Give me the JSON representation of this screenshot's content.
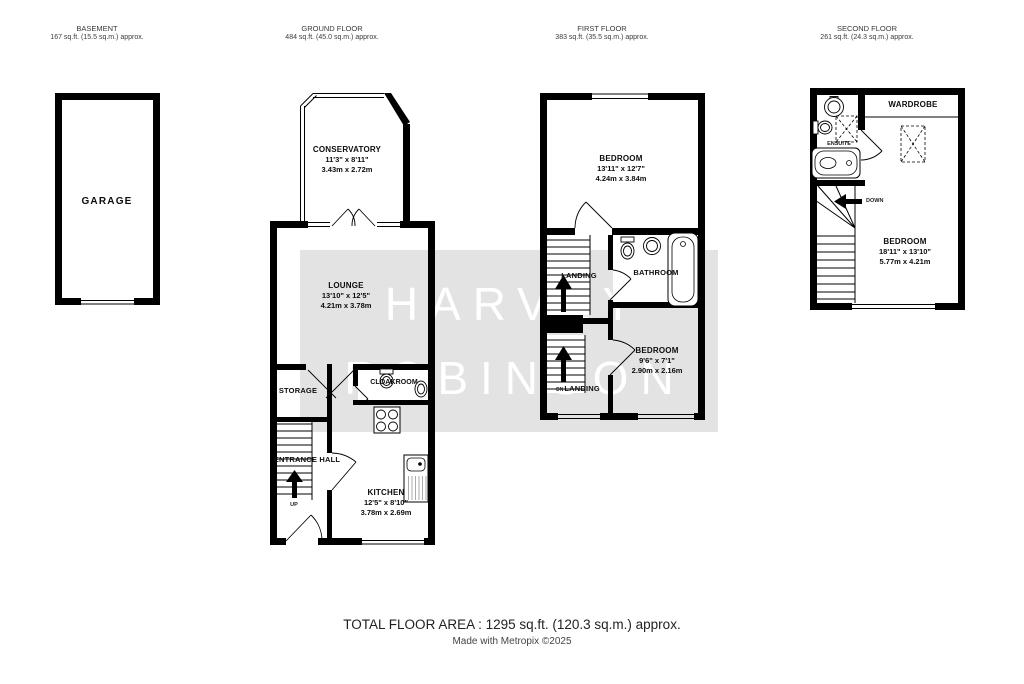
{
  "watermark": {
    "line1": "HARVEY",
    "line2": "ROBINSON"
  },
  "colors": {
    "wall": "#000000",
    "watermark_band": "#e3e3e3",
    "watermark_text": "#ffffff"
  },
  "floors": {
    "basement": {
      "title": "BASEMENT",
      "area": "167 sq.ft. (15.5 sq.m.) approx.",
      "rooms": {
        "garage": {
          "name": "GARAGE"
        }
      }
    },
    "ground": {
      "title": "GROUND FLOOR",
      "area": "484 sq.ft. (45.0 sq.m.) approx.",
      "rooms": {
        "conservatory": {
          "name": "CONSERVATORY",
          "imperial": "11'3\" x 8'11\"",
          "metric": "3.43m x 2.72m"
        },
        "lounge": {
          "name": "LOUNGE",
          "imperial": "13'10\" x 12'5\"",
          "metric": "4.21m x 3.78m"
        },
        "storage": {
          "name": "STORAGE"
        },
        "cloakroom": {
          "name": "CLOAKROOM"
        },
        "entrance_hall": {
          "name": "ENTRANCE HALL"
        },
        "kitchen": {
          "name": "KITCHEN",
          "imperial": "12'5\" x 8'10\"",
          "metric": "3.78m x 2.69m"
        }
      },
      "labels": {
        "up": "UP"
      }
    },
    "first": {
      "title": "FIRST FLOOR",
      "area": "383 sq.ft. (35.5 sq.m.) approx.",
      "rooms": {
        "bedroom1": {
          "name": "BEDROOM",
          "imperial": "13'11\" x 12'7\"",
          "metric": "4.24m x 3.84m"
        },
        "landing_upper": {
          "name": "LANDING"
        },
        "bathroom": {
          "name": "BATHROOM"
        },
        "bedroom2": {
          "name": "BEDROOM",
          "imperial": "9'6\" x 7'1\"",
          "metric": "2.90m x 2.16m"
        },
        "landing_lower": {
          "name": "LANDING",
          "prefix": "DN"
        }
      }
    },
    "second": {
      "title": "SECOND FLOOR",
      "area": "261 sq.ft. (24.3 sq.m.) approx.",
      "rooms": {
        "wardrobe": {
          "name": "WARDROBE"
        },
        "ensuite": {
          "name": "ENSUITE"
        },
        "bedroom3": {
          "name": "BEDROOM",
          "imperial": "18'11\" x 13'10\"",
          "metric": "5.77m x 4.21m"
        }
      },
      "labels": {
        "down": "DOWN"
      }
    }
  },
  "footer": {
    "total_area": "TOTAL FLOOR AREA : 1295 sq.ft. (120.3 sq.m.) approx.",
    "credit": "Made with Metropix ©2025"
  }
}
